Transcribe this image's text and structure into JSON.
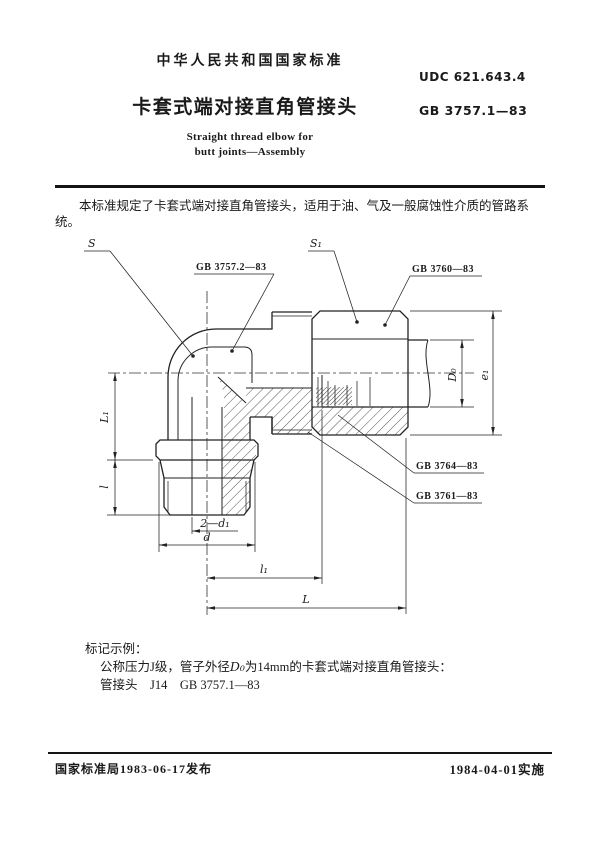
{
  "header": {
    "national_standard": "中华人民共和国国家标准",
    "udc": "UDC 621.643.4",
    "title_zh": "卡套式端对接直角管接头",
    "standard_no": "GB 3757.1—83",
    "title_en_line1": "Straight thread elbow for",
    "title_en_line2": "butt joints—Assembly"
  },
  "scope": "本标准规定了卡套式端对接直角管接头，适用于油、气及一般腐蚀性介质的管路系统。",
  "drawing": {
    "parts": {
      "body": "GB 3757.2—83",
      "nut": "GB 3760—83",
      "ferrule": "GB 3764—83",
      "ring": "GB 3761—83"
    },
    "dims": {
      "s": "S",
      "s1": "S₁",
      "L1": "L₁",
      "l_small": "l",
      "D0": "D₀",
      "e1": "e₁",
      "two_d1": "2—d₁",
      "d": "d",
      "l1": "l₁",
      "L": "L"
    }
  },
  "marking": {
    "heading": "标记示例：",
    "line1_pre": "公称压力J级，管子外径",
    "line1_var": "D₀",
    "line1_post": "为14mm的卡套式端对接直角管接头：",
    "line2": "管接头　J14　GB 3757.1—83"
  },
  "footer": {
    "issued": "国家标准局1983-06-17发布",
    "implemented": "1984-04-01实施"
  }
}
